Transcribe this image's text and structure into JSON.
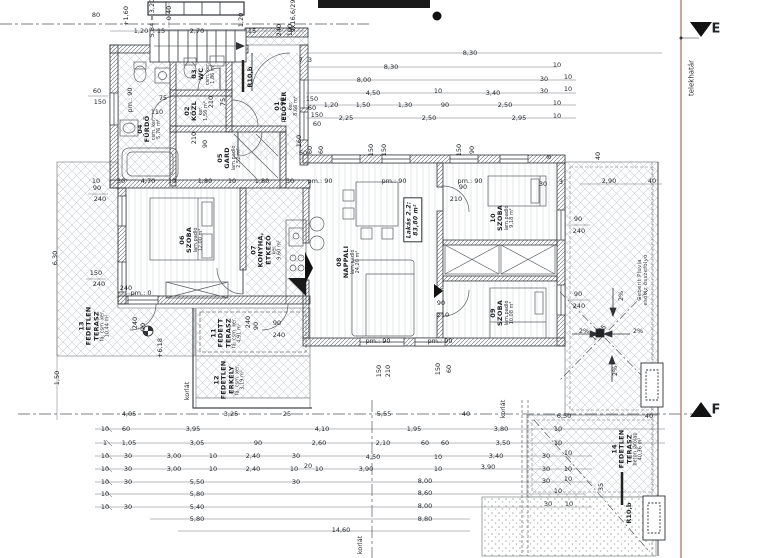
{
  "drawing": {
    "type": "architectural floor plan",
    "apartment_label": "Lakás 2.2:",
    "apartment_area": "83,80 m²",
    "boundary_color": "#b08272",
    "line_color": "#2f3337"
  },
  "rooms": [
    {
      "n": "room-label-eloter",
      "lines": [
        "01",
        "ELŐTÉR"
      ],
      "sub": [
        "ker.",
        "8,66 m²"
      ],
      "x": 287,
      "y": 106
    },
    {
      "n": "room-label-kozl",
      "lines": [
        "02",
        "KÖZL"
      ],
      "sub": [
        "ker.",
        "1,56 m²"
      ],
      "x": 197,
      "y": 111
    },
    {
      "n": "room-label-wc",
      "lines": [
        "03",
        "WC"
      ],
      "sub": [
        "csm. ker.",
        "1,86 m²"
      ],
      "x": 204,
      "y": 74
    },
    {
      "n": "room-label-furdo",
      "lines": [
        "04",
        "FÜRDŐ"
      ],
      "sub": [
        "csm. ker.",
        "5,76 m²"
      ],
      "x": 150,
      "y": 129
    },
    {
      "n": "room-label-gard",
      "lines": [
        "05",
        "GARD"
      ],
      "sub": [
        "lam.padló",
        "2,52 m²"
      ],
      "x": 230,
      "y": 158
    },
    {
      "n": "room-label-szoba-06",
      "lines": [
        "06",
        "SZOBA"
      ],
      "sub": [
        "lam.padló",
        "12,00 m²"
      ],
      "x": 192,
      "y": 240
    },
    {
      "n": "room-label-konyha",
      "lines": [
        "07",
        "KONYHA,",
        "ÉTKEZŐ"
      ],
      "sub": [
        "ker.",
        "9,60 m²"
      ],
      "x": 267,
      "y": 250
    },
    {
      "n": "room-label-nappali",
      "lines": [
        "08",
        "NAPPALI"
      ],
      "sub": [
        "lam.padló",
        "24,20 m²"
      ],
      "x": 349,
      "y": 262
    },
    {
      "n": "room-label-szoba-09",
      "lines": [
        "09",
        "SZOBA"
      ],
      "sub": [
        "lam.padló",
        "10,08 m²"
      ],
      "x": 503,
      "y": 313
    },
    {
      "n": "room-label-szoba-10",
      "lines": [
        "10",
        "SZOBA"
      ],
      "sub": [
        "lam.padló",
        "9,18 m²"
      ],
      "x": 503,
      "y": 218
    },
    {
      "n": "room-label-fedett-terasz",
      "lines": [
        "11",
        "FEDETT",
        "TERASZ"
      ],
      "sub": [
        "fá. csm. ker.",
        "4,91 m²"
      ],
      "x": 227,
      "y": 333
    },
    {
      "n": "room-label-erkely",
      "lines": [
        "12",
        "FEDETLEN",
        "ERKÉLY"
      ],
      "sub": [
        "fá. csm. ker.",
        "3,19 m²"
      ],
      "x": 230,
      "y": 380
    },
    {
      "n": "room-label-fedetlen-terasz-13",
      "lines": [
        "13",
        "FEDETLEN",
        "TERASZ"
      ],
      "sub": [
        "fá. csm. ker.",
        "10,44 m²"
      ],
      "x": 95,
      "y": 326
    },
    {
      "n": "room-label-fedetlen-terasz-14",
      "lines": [
        "14",
        "FEDETLEN",
        "TERASZ"
      ],
      "sub": [
        "beton járólap",
        "40,36 m²"
      ],
      "x": 628,
      "y": 449
    },
    {
      "n": "apartment-area-box",
      "boxed": true,
      "lines": [
        "Lakás 2.2:",
        "83,80 m²"
      ],
      "sub": [],
      "x": 413,
      "y": 220
    },
    {
      "n": "roof-drain-note",
      "light": true,
      "lines": [
        "Geberit Pluvia",
        "esővíz összefolyó"
      ],
      "sub": [],
      "x": 643,
      "y": 280
    }
  ],
  "labels": [
    {
      "t": "80",
      "x": 96,
      "y": 15
    },
    {
      "t": "0,40",
      "x": 169,
      "y": 13,
      "r": -90
    },
    {
      "t": "5,84 = 3,20",
      "x": 152,
      "y": 18,
      "r": -90
    },
    {
      "t": "+1,60",
      "x": 126,
      "y": 16,
      "r": -90
    },
    {
      "t": "9x16,6/29",
      "x": 293,
      "y": 16,
      "r": -90
    },
    {
      "t": "1,20",
      "x": 141,
      "y": 31
    },
    {
      "t": "15",
      "x": 161,
      "y": 31
    },
    {
      "t": "2,70",
      "x": 197,
      "y": 31
    },
    {
      "t": "1,20",
      "x": 241,
      "y": 20,
      "r": -90
    },
    {
      "t": "15",
      "x": 252,
      "y": 31
    },
    {
      "t": "240",
      "x": 279,
      "y": 30,
      "r": -90
    },
    {
      "t": "100",
      "x": 290,
      "y": 30,
      "r": -90
    },
    {
      "t": "60",
      "x": 97,
      "y": 91
    },
    {
      "t": "150",
      "x": 100,
      "y": 102
    },
    {
      "t": "pm.: 90",
      "x": 130,
      "y": 100,
      "r": -90
    },
    {
      "t": "90",
      "x": 97,
      "y": 188
    },
    {
      "t": "240",
      "x": 100,
      "y": 199
    },
    {
      "t": "150",
      "x": 96,
      "y": 273
    },
    {
      "t": "240",
      "x": 99,
      "y": 284
    },
    {
      "t": "pm.: 0",
      "x": 141,
      "y": 293
    },
    {
      "t": "6,30",
      "x": 55,
      "y": 258,
      "r": -90
    },
    {
      "t": "1,50",
      "x": 57,
      "y": 378,
      "r": -90
    },
    {
      "t": "10",
      "x": 96,
      "y": 181
    },
    {
      "t": "30",
      "x": 121,
      "y": 181
    },
    {
      "t": "4,70",
      "x": 148,
      "y": 181
    },
    {
      "t": "10",
      "x": 172,
      "y": 181
    },
    {
      "t": "1,80",
      "x": 205,
      "y": 181
    },
    {
      "t": "10",
      "x": 232,
      "y": 181
    },
    {
      "t": "1,80",
      "x": 262,
      "y": 181
    },
    {
      "t": "30",
      "x": 290,
      "y": 181
    },
    {
      "t": "pm.: 90",
      "x": 320,
      "y": 181
    },
    {
      "t": "pm.: 90",
      "x": 394,
      "y": 181
    },
    {
      "t": "pm.: 90",
      "x": 470,
      "y": 181
    },
    {
      "t": "30",
      "x": 543,
      "y": 184
    },
    {
      "t": "pm.: 90",
      "x": 378,
      "y": 341
    },
    {
      "t": "pm.: 90",
      "x": 440,
      "y": 341
    },
    {
      "t": "75",
      "x": 163,
      "y": 98
    },
    {
      "t": "110",
      "x": 157,
      "y": 112
    },
    {
      "t": "210",
      "x": 211,
      "y": 102,
      "r": -90
    },
    {
      "t": "75",
      "x": 223,
      "y": 102,
      "r": -90
    },
    {
      "t": "210",
      "x": 194,
      "y": 138,
      "r": -90
    },
    {
      "t": "90",
      "x": 205,
      "y": 144,
      "r": -90
    },
    {
      "t": "pm.: 90",
      "x": 283,
      "y": 110,
      "r": -90
    },
    {
      "t": "150",
      "x": 312,
      "y": 99
    },
    {
      "t": "60",
      "x": 312,
      "y": 108
    },
    {
      "t": "150",
      "x": 317,
      "y": 115
    },
    {
      "t": "60",
      "x": 317,
      "y": 124
    },
    {
      "t": "160",
      "x": 299,
      "y": 141,
      "r": -90
    },
    {
      "t": "60",
      "x": 303,
      "y": 153
    },
    {
      "t": "7",
      "x": 301,
      "y": 60
    },
    {
      "t": "3",
      "x": 310,
      "y": 60
    },
    {
      "t": "R10,b",
      "x": 250,
      "y": 77,
      "r": -90,
      "b": 1,
      "n": "downpipe-label"
    },
    {
      "t": "8,30",
      "x": 470,
      "y": 53
    },
    {
      "t": "8,30",
      "x": 391,
      "y": 67
    },
    {
      "t": "10",
      "x": 557,
      "y": 65
    },
    {
      "t": "8,00",
      "x": 364,
      "y": 80
    },
    {
      "t": "30",
      "x": 544,
      "y": 79
    },
    {
      "t": "10",
      "x": 568,
      "y": 77
    },
    {
      "t": "4,50",
      "x": 373,
      "y": 93
    },
    {
      "t": "10",
      "x": 438,
      "y": 91
    },
    {
      "t": "3,40",
      "x": 493,
      "y": 93
    },
    {
      "t": "30",
      "x": 544,
      "y": 91
    },
    {
      "t": "10",
      "x": 568,
      "y": 89
    },
    {
      "t": "1,20",
      "x": 331,
      "y": 105
    },
    {
      "t": "1,50",
      "x": 363,
      "y": 105
    },
    {
      "t": "1,30",
      "x": 405,
      "y": 105
    },
    {
      "t": "90",
      "x": 445,
      "y": 105
    },
    {
      "t": "2,50",
      "x": 505,
      "y": 105
    },
    {
      "t": "10",
      "x": 557,
      "y": 103
    },
    {
      "t": "2,25",
      "x": 346,
      "y": 118
    },
    {
      "t": "2,50",
      "x": 429,
      "y": 118
    },
    {
      "t": "2,95",
      "x": 519,
      "y": 118
    },
    {
      "t": "10",
      "x": 557,
      "y": 116
    },
    {
      "t": "60",
      "x": 310,
      "y": 150,
      "r": -90
    },
    {
      "t": "60",
      "x": 321,
      "y": 150,
      "r": -90
    },
    {
      "t": "150",
      "x": 371,
      "y": 150,
      "r": -90
    },
    {
      "t": "150",
      "x": 384,
      "y": 150,
      "r": -90
    },
    {
      "t": "150",
      "x": 459,
      "y": 150,
      "r": -90
    },
    {
      "t": "90",
      "x": 472,
      "y": 150,
      "r": -90
    },
    {
      "t": "8",
      "x": 549,
      "y": 157,
      "r": -90
    },
    {
      "t": "40",
      "x": 598,
      "y": 156,
      "r": -90
    },
    {
      "t": "3",
      "x": 561,
      "y": 182
    },
    {
      "t": "2,90",
      "x": 609,
      "y": 181
    },
    {
      "t": "40",
      "x": 652,
      "y": 181
    },
    {
      "t": "90",
      "x": 463,
      "y": 187
    },
    {
      "t": "210",
      "x": 456,
      "y": 199
    },
    {
      "t": "90",
      "x": 441,
      "y": 303
    },
    {
      "t": "210",
      "x": 443,
      "y": 315
    },
    {
      "t": "90",
      "x": 578,
      "y": 219
    },
    {
      "t": "240",
      "x": 579,
      "y": 231
    },
    {
      "t": "90",
      "x": 578,
      "y": 294
    },
    {
      "t": "240",
      "x": 579,
      "y": 306
    },
    {
      "t": "2%",
      "x": 621,
      "y": 296,
      "r": -90,
      "n": "slope-label"
    },
    {
      "t": "2%",
      "x": 584,
      "y": 331,
      "n": "slope-label"
    },
    {
      "t": "2%",
      "x": 638,
      "y": 331,
      "n": "slope-label"
    },
    {
      "t": "10,25",
      "x": 599,
      "y": 333,
      "r": -48
    },
    {
      "t": "2%",
      "x": 615,
      "y": 371,
      "r": -90,
      "n": "slope-label"
    },
    {
      "t": "35",
      "x": 601,
      "y": 487,
      "r": -90
    },
    {
      "t": "R10,b",
      "x": 629,
      "y": 513,
      "r": -90,
      "b": 1,
      "n": "downpipe-label"
    },
    {
      "t": "150",
      "x": 379,
      "y": 371,
      "r": -90
    },
    {
      "t": "210",
      "x": 388,
      "y": 371,
      "r": -90
    },
    {
      "t": "150",
      "x": 438,
      "y": 369,
      "r": -90
    },
    {
      "t": "60",
      "x": 449,
      "y": 369,
      "r": -90
    },
    {
      "t": "240",
      "x": 126,
      "y": 288
    },
    {
      "t": "240",
      "x": 135,
      "y": 323,
      "r": -90
    },
    {
      "t": "90",
      "x": 143,
      "y": 327,
      "r": -90
    },
    {
      "t": "+6,18",
      "x": 160,
      "y": 348,
      "r": -90,
      "n": "level-label"
    },
    {
      "t": "240",
      "x": 248,
      "y": 322,
      "r": -90
    },
    {
      "t": "90",
      "x": 256,
      "y": 326,
      "r": -90
    },
    {
      "t": "90",
      "x": 277,
      "y": 323
    },
    {
      "t": "240",
      "x": 279,
      "y": 335
    },
    {
      "t": "korlát",
      "x": 187,
      "y": 391,
      "r": -90,
      "n": "railing-label"
    },
    {
      "t": "korlát",
      "x": 503,
      "y": 409,
      "r": -90,
      "n": "railing-label"
    },
    {
      "t": "korlát",
      "x": 360,
      "y": 545,
      "r": -90,
      "n": "railing-label"
    },
    {
      "t": "4,05",
      "x": 129,
      "y": 414
    },
    {
      "t": "3,25",
      "x": 231,
      "y": 414
    },
    {
      "t": "25",
      "x": 287,
      "y": 414
    },
    {
      "t": "5,55",
      "x": 384,
      "y": 414
    },
    {
      "t": "40",
      "x": 466,
      "y": 414
    },
    {
      "t": "6,50",
      "x": 564,
      "y": 416
    },
    {
      "t": "40",
      "x": 649,
      "y": 416
    },
    {
      "t": "10",
      "x": 105,
      "y": 429
    },
    {
      "t": "60",
      "x": 126,
      "y": 429
    },
    {
      "t": "3,95",
      "x": 193,
      "y": 429
    },
    {
      "t": "4,10",
      "x": 322,
      "y": 429
    },
    {
      "t": "1,95",
      "x": 414,
      "y": 429
    },
    {
      "t": "3,80",
      "x": 501,
      "y": 429
    },
    {
      "t": "10",
      "x": 558,
      "y": 429
    },
    {
      "t": "1",
      "x": 105,
      "y": 443
    },
    {
      "t": "1,05",
      "x": 129,
      "y": 443
    },
    {
      "t": "3,05",
      "x": 197,
      "y": 443
    },
    {
      "t": "90",
      "x": 258,
      "y": 443
    },
    {
      "t": "2,60",
      "x": 319,
      "y": 443
    },
    {
      "t": "2,10",
      "x": 383,
      "y": 443
    },
    {
      "t": "60",
      "x": 425,
      "y": 443
    },
    {
      "t": "60",
      "x": 445,
      "y": 443
    },
    {
      "t": "3,50",
      "x": 503,
      "y": 443
    },
    {
      "t": "10",
      "x": 558,
      "y": 443
    },
    {
      "t": "10",
      "x": 105,
      "y": 456
    },
    {
      "t": "30",
      "x": 128,
      "y": 456
    },
    {
      "t": "3,00",
      "x": 174,
      "y": 456
    },
    {
      "t": "10",
      "x": 213,
      "y": 456
    },
    {
      "t": "2,40",
      "x": 253,
      "y": 456
    },
    {
      "t": "30",
      "x": 296,
      "y": 456
    },
    {
      "t": "4,50",
      "x": 373,
      "y": 457
    },
    {
      "t": "10",
      "x": 438,
      "y": 457
    },
    {
      "t": "3,40",
      "x": 496,
      "y": 456
    },
    {
      "t": "30",
      "x": 546,
      "y": 456
    },
    {
      "t": "10",
      "x": 568,
      "y": 453
    },
    {
      "t": "10",
      "x": 105,
      "y": 469
    },
    {
      "t": "30",
      "x": 128,
      "y": 469
    },
    {
      "t": "3,00",
      "x": 174,
      "y": 469
    },
    {
      "t": "10",
      "x": 213,
      "y": 469
    },
    {
      "t": "2,40",
      "x": 253,
      "y": 469
    },
    {
      "t": "10",
      "x": 294,
      "y": 469
    },
    {
      "t": "20",
      "x": 308,
      "y": 466
    },
    {
      "t": "10",
      "x": 319,
      "y": 469
    },
    {
      "t": "3,90",
      "x": 366,
      "y": 469
    },
    {
      "t": "10",
      "x": 438,
      "y": 469
    },
    {
      "t": "3,90",
      "x": 488,
      "y": 467
    },
    {
      "t": "30",
      "x": 546,
      "y": 469
    },
    {
      "t": "10",
      "x": 568,
      "y": 469
    },
    {
      "t": "10",
      "x": 105,
      "y": 482
    },
    {
      "t": "30",
      "x": 128,
      "y": 482
    },
    {
      "t": "5,50",
      "x": 197,
      "y": 482
    },
    {
      "t": "30",
      "x": 296,
      "y": 482
    },
    {
      "t": "8,00",
      "x": 425,
      "y": 481
    },
    {
      "t": "30",
      "x": 546,
      "y": 481
    },
    {
      "t": "10",
      "x": 568,
      "y": 479
    },
    {
      "t": "10",
      "x": 105,
      "y": 494
    },
    {
      "t": "5,80",
      "x": 197,
      "y": 494
    },
    {
      "t": "8,60",
      "x": 425,
      "y": 493
    },
    {
      "t": "10",
      "x": 558,
      "y": 491
    },
    {
      "t": "10",
      "x": 105,
      "y": 507
    },
    {
      "t": "30",
      "x": 128,
      "y": 507
    },
    {
      "t": "5,40",
      "x": 197,
      "y": 507
    },
    {
      "t": "8,00",
      "x": 425,
      "y": 506
    },
    {
      "t": "30",
      "x": 548,
      "y": 504
    },
    {
      "t": "10",
      "x": 569,
      "y": 504
    },
    {
      "t": "5,80",
      "x": 197,
      "y": 519
    },
    {
      "t": "8,80",
      "x": 425,
      "y": 519
    },
    {
      "t": "14,60",
      "x": 341,
      "y": 530
    },
    {
      "t": "E",
      "x": 716,
      "y": 29,
      "s": 13,
      "b": 1,
      "n": "marker-e-label"
    },
    {
      "t": "F",
      "x": 716,
      "y": 410,
      "s": 13,
      "b": 1,
      "n": "marker-f-label"
    },
    {
      "t": "telekhatár",
      "x": 692,
      "y": 78,
      "r": -90,
      "s": 7,
      "n": "property-line-label"
    }
  ]
}
